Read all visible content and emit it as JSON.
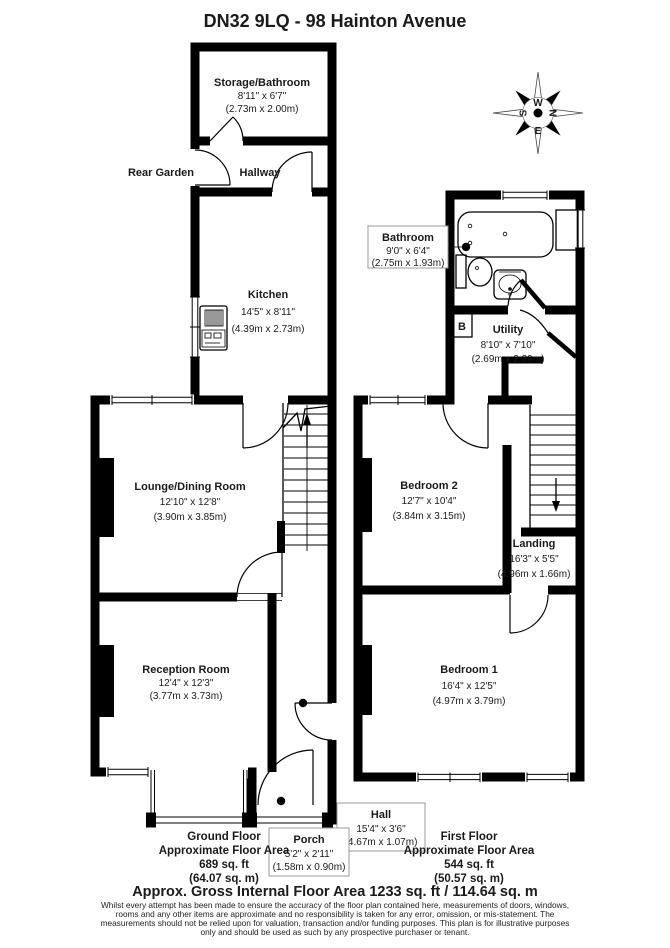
{
  "title": "DN32 9LQ - 98 Hainton Avenue",
  "compass": {
    "n": "N",
    "s": "S",
    "e": "E",
    "w": "W"
  },
  "rooms": {
    "storage_bathroom": {
      "name": "Storage/Bathroom",
      "imperial": "8'11\" x 6'7\"",
      "metric": "(2.73m x 2.00m)"
    },
    "rear_garden": {
      "name": "Rear Garden"
    },
    "hallway": {
      "name": "Hallway"
    },
    "kitchen": {
      "name": "Kitchen",
      "imperial": "14'5\" x 8'11\"",
      "metric": "(4.39m x 2.73m)"
    },
    "lounge_dining": {
      "name": "Lounge/Dining Room",
      "imperial": "12'10\" x 12'8\"",
      "metric": "(3.90m x 3.85m)"
    },
    "reception": {
      "name": "Reception Room",
      "imperial": "12'4\" x 12'3\"",
      "metric": "(3.77m x 3.73m)"
    },
    "hall": {
      "name": "Hall",
      "imperial": "15'4\" x 3'6\"",
      "metric": "(4.67m x 1.07m)"
    },
    "porch": {
      "name": "Porch",
      "imperial": "5'2\" x 2'11\"",
      "metric": "(1.58m x 0.90m)"
    },
    "bathroom": {
      "name": "Bathroom",
      "imperial": "9'0\" x 6'4\"",
      "metric": "(2.75m x 1.93m)"
    },
    "utility": {
      "name": "Utility",
      "imperial": "8'10\" x 7'10\"",
      "metric": "(2.69m x 2.39m)"
    },
    "bedroom2": {
      "name": "Bedroom 2",
      "imperial": "12'7\" x 10'4\"",
      "metric": "(3.84m x 3.15m)"
    },
    "landing": {
      "name": "Landing",
      "imperial": "16'3\" x 5'5\"",
      "metric": "(4.96m x 1.66m)"
    },
    "bedroom1": {
      "name": "Bedroom 1",
      "imperial": "16'4\" x 12'5\"",
      "metric": "(4.97m x 3.79m)"
    },
    "boiler": {
      "label": "B"
    }
  },
  "areas": {
    "ground_floor": {
      "title_line": "Ground Floor",
      "subtitle": "Approximate Floor Area",
      "sqft": "689 sq. ft",
      "sqm": "(64.07 sq. m)"
    },
    "first_floor": {
      "title_line": "First Floor",
      "subtitle": "Approximate Floor Area",
      "sqft": "544 sq. ft",
      "sqm": "(50.57 sq. m)"
    }
  },
  "footer": {
    "total": "Approx. Gross Internal Floor Area 1233 sq. ft / 114.64 sq. m",
    "disclaimer_line1": "Whilst every attempt has been made to ensure the accuracy of the floor plan contained here, measurements of doors, windows,",
    "disclaimer_line2": "rooms and any other items are approximate and no responsibility is taken for any error, omission, or mis-statement. The",
    "disclaimer_line3": "measurements should not be relied upon for valuation, transaction and/or funding purposes. This plan is for illustrative purposes",
    "disclaimer_line4": "only and should be used as such by any prospective purchaser or tenant."
  },
  "colors": {
    "wall": "#000000",
    "background": "#ffffff"
  }
}
